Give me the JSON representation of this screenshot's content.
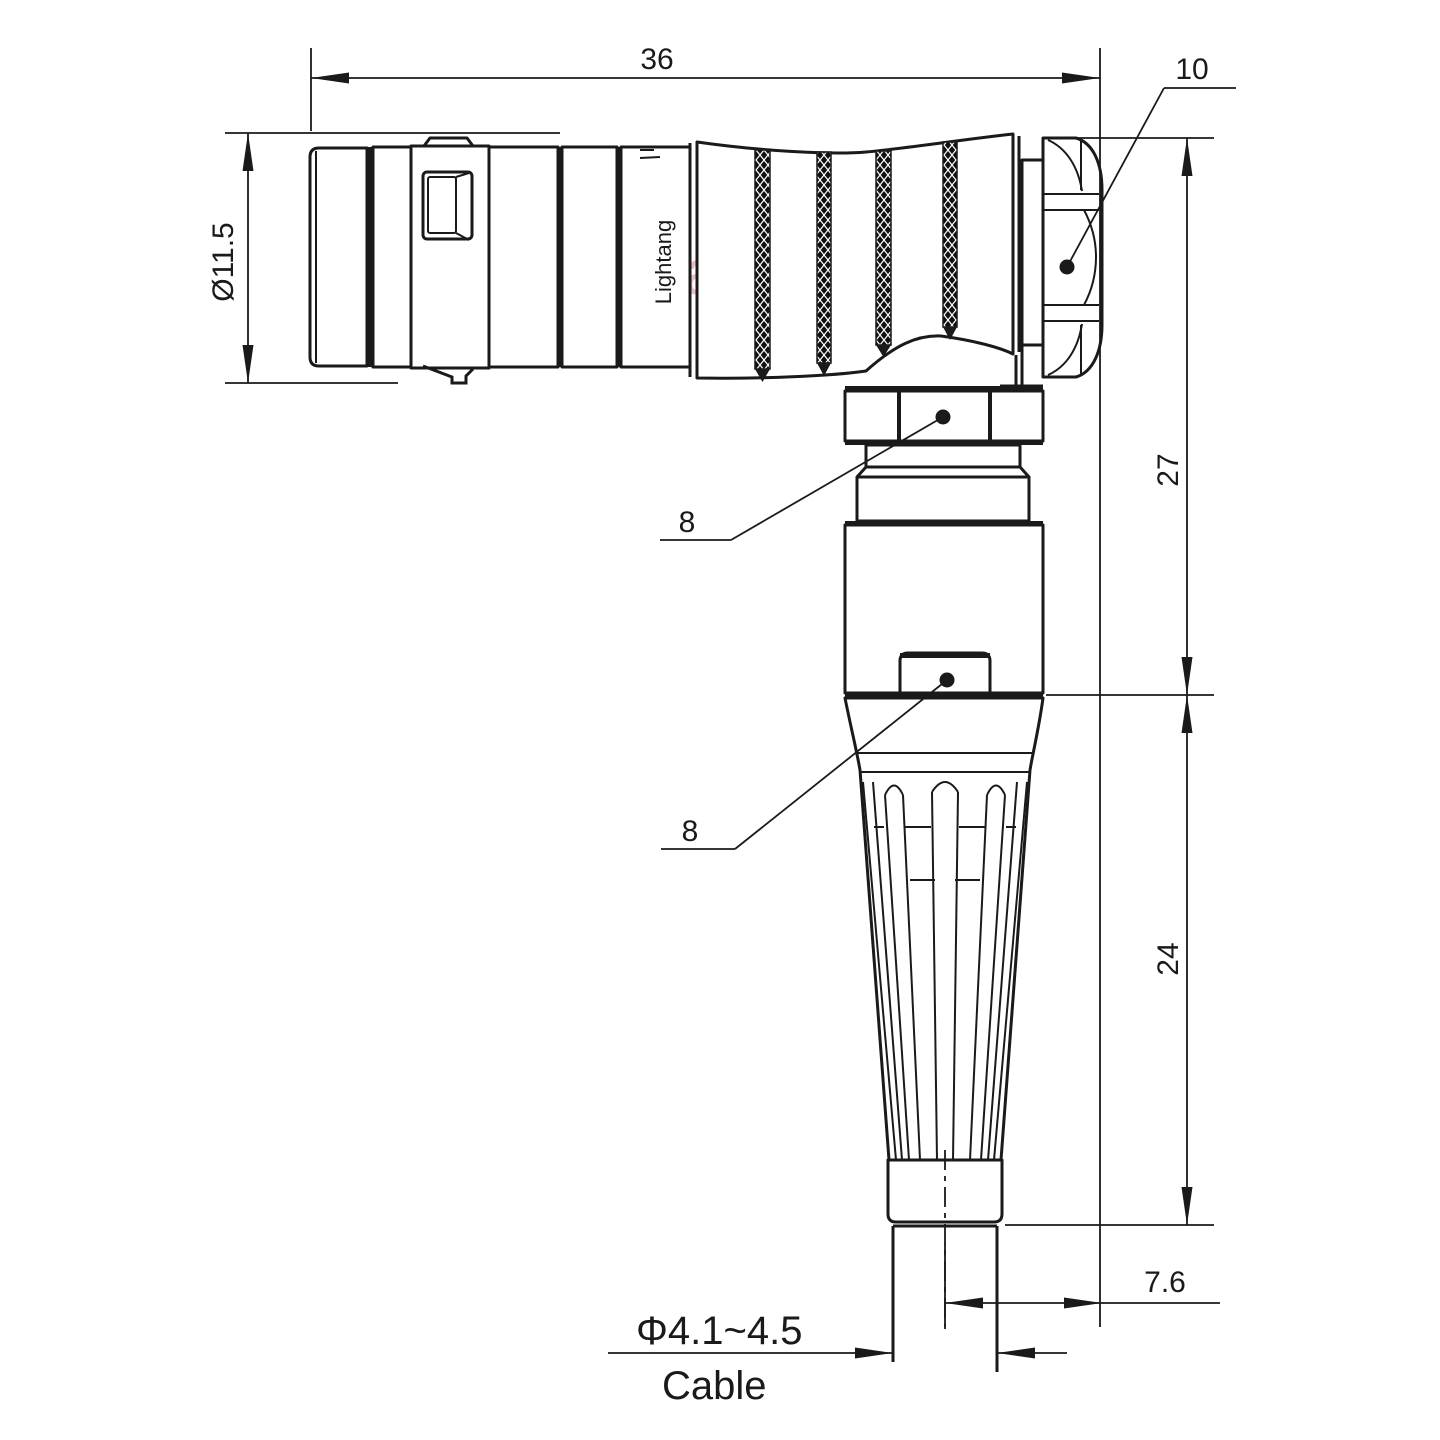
{
  "dimensions": {
    "overall_length": "36",
    "nut_size": "10",
    "front_diameter": "Ø11.5",
    "upper_height": "27",
    "lower_height": "24",
    "hex_nut_flats": "8",
    "boss_flats": "8",
    "cable_offset": "7.6",
    "cable_diameter": "Φ4.1~4.5",
    "cable_label": "Cable"
  },
  "watermark": {
    "text": "Lightang"
  },
  "engraving": {
    "text": "Lightang"
  },
  "colors": {
    "line": "#1a1a1a",
    "background": "#ffffff",
    "watermark": "#d98f8f"
  }
}
